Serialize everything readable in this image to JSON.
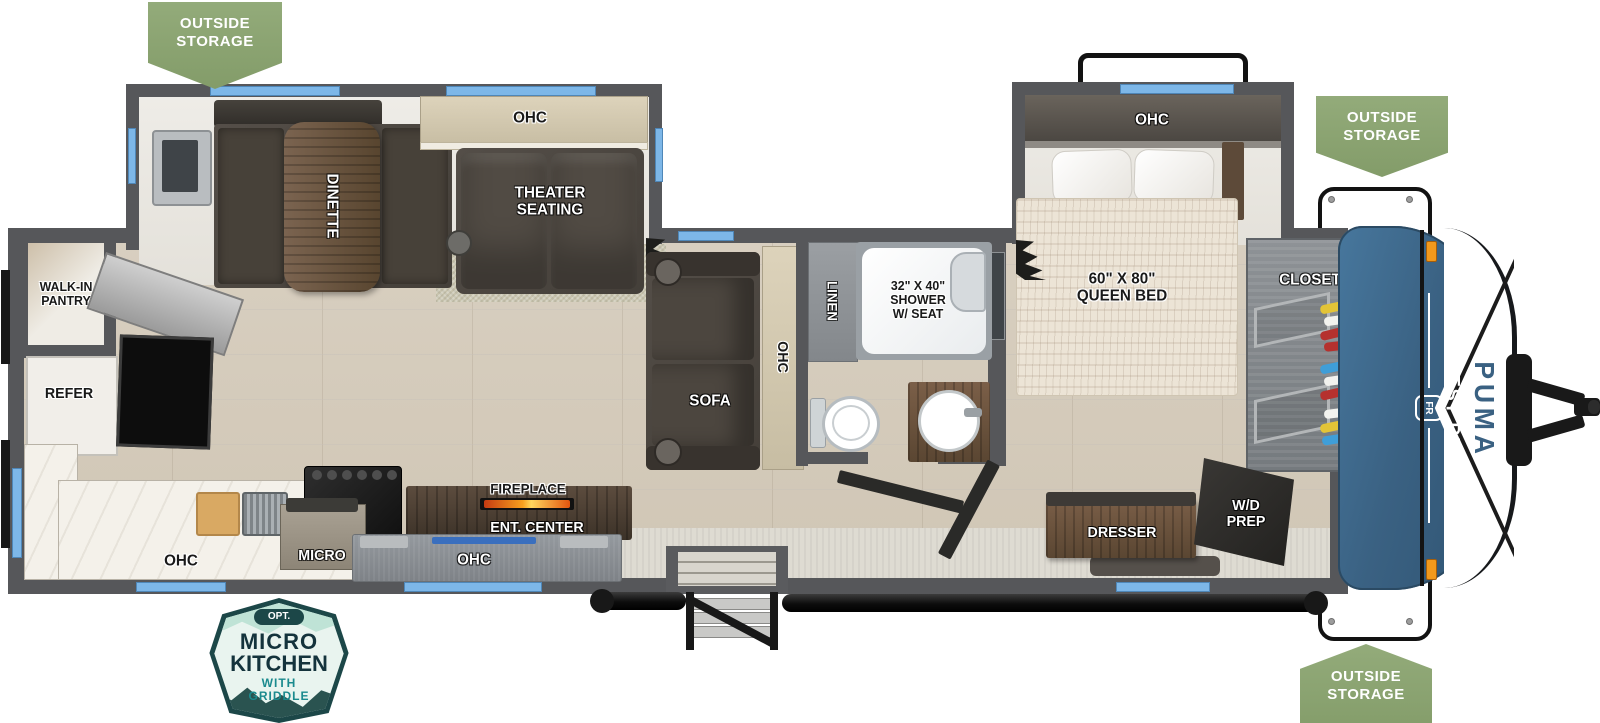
{
  "title": "Forest River Puma travel trailer floorplan",
  "badges": [
    {
      "text": "OUTSIDE\nSTORAGE"
    },
    {
      "text": "OUTSIDE\nSTORAGE"
    },
    {
      "text": "OUTSIDE\nSTORAGE"
    }
  ],
  "option_badge": {
    "tag": "OPT.",
    "line1": "MICRO",
    "line2": "KITCHEN",
    "sub1": "WITH",
    "sub2": "GRIDDLE"
  },
  "labels": {
    "walk_in_pantry": "WALK-IN\nPANTRY",
    "refer": "REFER",
    "ohc_kitchen": "OHC",
    "micro": "MICRO",
    "ohc_galley": "OHC",
    "ent_center": "ENT. CENTER",
    "fireplace": "FIREPLACE",
    "dinette": "DINETTE",
    "ohc_dinette_slide": "OHC",
    "theater_seating": "THEATER\nSEATING",
    "sofa": "SOFA",
    "ohc_sofa": "OHC",
    "linen": "LINEN",
    "shower": "32\" X 40\"\nSHOWER\nW/ SEAT",
    "ohc_bedroom": "OHC",
    "queen_bed": "60\" X 80\"\nQUEEN BED",
    "closet": "CLOSET",
    "dresser": "DRESSER",
    "wd_prep": "W/D\nPREP"
  },
  "brand": {
    "maker": "FOREST RIVER",
    "model": "PUMA",
    "logo_initials": "FR"
  },
  "colors": {
    "badge_green": "#8aa371",
    "wall_gray": "#56575a",
    "window_blue": "#7db7e8",
    "cap_blue": "#3a6182",
    "fireplace_orange": "#f2991c",
    "option_badge_teal": "#1c4748",
    "option_badge_mint": "#e9f4ef"
  }
}
